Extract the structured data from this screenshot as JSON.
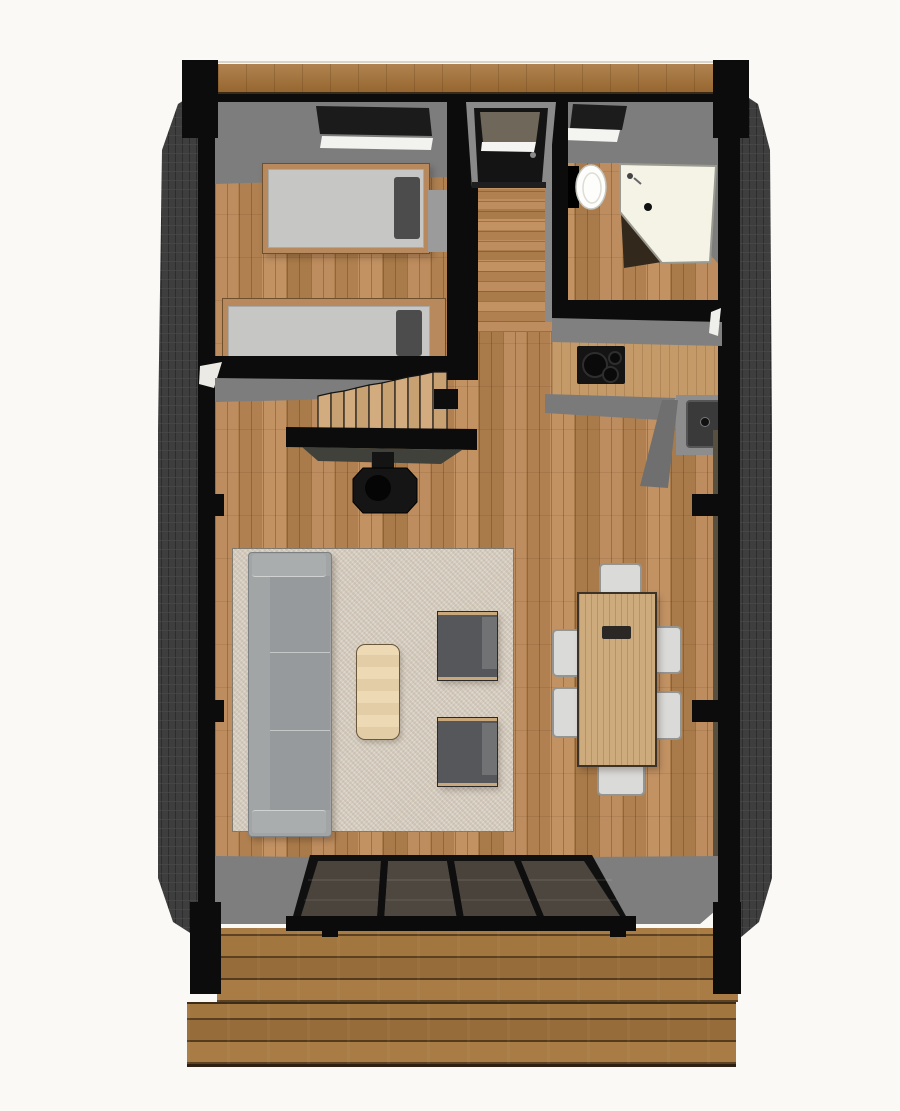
{
  "meta": {
    "type": "3d-floor-plan-render",
    "view": "top-down cutaway",
    "text_on_screen": "none"
  },
  "palette": {
    "background": "#faf9f6",
    "wall_black": "#0c0c0c",
    "roof_slope_gray": "#7d7d7d",
    "siding_dark": "#3e3e3e",
    "floor_wood": "#b5885a",
    "deck_wood": "#9c7140",
    "ridge_wood": "#a87c4c",
    "rug_beige": "#d6cdbf",
    "sofa_gray": "#a2a5a6",
    "armchair_dark_gray": "#55575b",
    "coffee_table_cream": "#ead7b0",
    "dining_table_wood": "#cdab7d",
    "dining_chair_light": "#dadad8",
    "bed_mattress_gray": "#c6c6c4",
    "pillow_dark_gray": "#4c4c4c",
    "bed_frame_wood": "#b8895c",
    "shower_tray_cream": "#f5f3e6",
    "toilet_white": "#fdfdfb",
    "counter_wood": "#c49a69",
    "sink_counter_gray": "#8d8d8d",
    "sink_basin_dark": "#3a3a3a",
    "cooktop_black": "#141414",
    "stove_black": "#151515",
    "stair_tread_wood": "#c8a173",
    "glass_pane_dark": "#4a443c",
    "window_strip_olive": "#57503e"
  },
  "scene": {
    "exterior": {
      "corner_posts": 4,
      "side_walls": "dark textured siding, slanted",
      "ridge_beam": "wood strip along top edge",
      "deck": {
        "levels": 2,
        "planks": "horizontal"
      }
    },
    "rooms": [
      {
        "name": "bedroom",
        "position": "top-left",
        "items": [
          "single-bed-upper",
          "single-bed-lower",
          "skylight",
          "bedside-shelf"
        ]
      },
      {
        "name": "entry-hall",
        "position": "top-center",
        "items": [
          "entry-door"
        ]
      },
      {
        "name": "bathroom",
        "position": "top-right",
        "items": [
          "toilet",
          "corner-shower-tray",
          "skylight"
        ]
      },
      {
        "name": "kitchen",
        "position": "right-middle",
        "items": [
          "l-shaped-counter",
          "induction-cooktop",
          "sink-with-faucet"
        ]
      },
      {
        "name": "stair-zone",
        "position": "left-middle",
        "items": [
          "staircase-9-treads",
          "landing",
          "guard-wall",
          "wood-stove-with-flue"
        ]
      },
      {
        "name": "living-room",
        "position": "center",
        "items": [
          "area-rug",
          "sofa",
          "coffee-table",
          "armchair-1",
          "armchair-2"
        ]
      },
      {
        "name": "dining-area",
        "position": "center-right",
        "items": [
          "dining-table",
          "serving-tray",
          "chair-top",
          "chair-bottom",
          "chair-left-1",
          "chair-left-2",
          "chair-right-1",
          "chair-right-2"
        ]
      }
    ],
    "glazed_front_wall": {
      "position": "bottom",
      "panes": 4,
      "frame": "black"
    }
  }
}
